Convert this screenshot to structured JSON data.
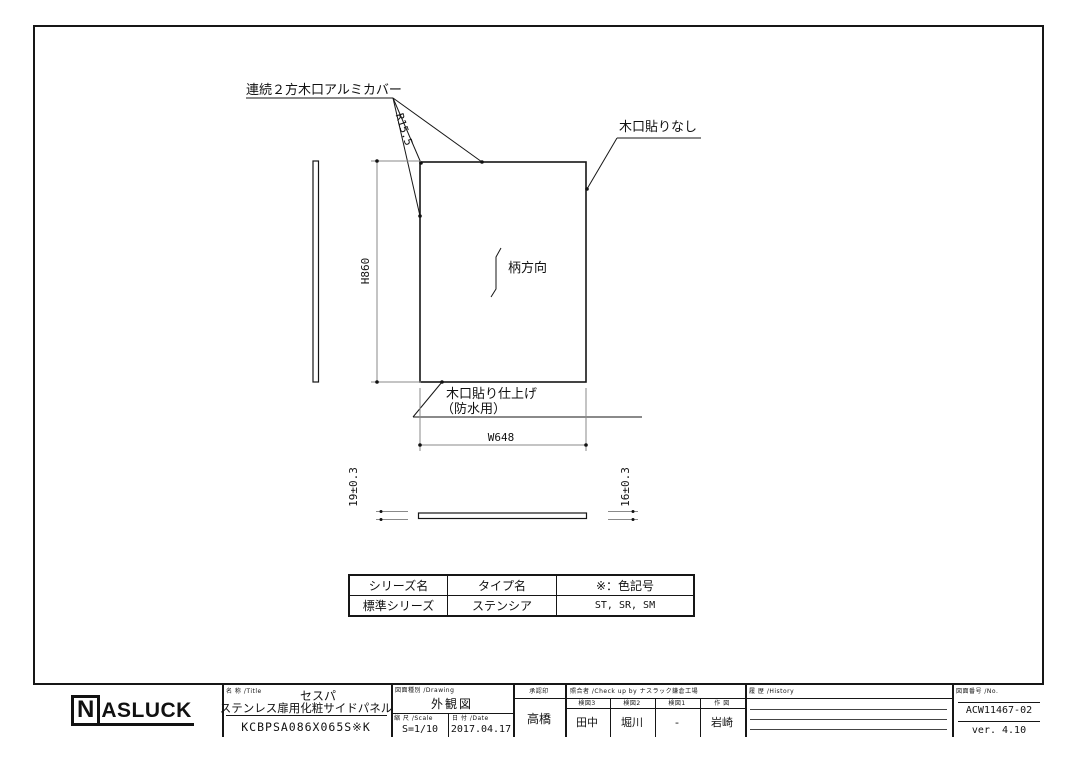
{
  "drawing": {
    "labels": {
      "edge_cover": "連続２方木口アルミカバー",
      "radius": "R15.5",
      "no_edge_band": "木口貼りなし",
      "grain_direction": "柄方向",
      "edge_band_finish_line1": "木口貼り仕上げ",
      "edge_band_finish_line2": "（防水用）"
    },
    "dimensions": {
      "height": "H860",
      "width": "W648",
      "thickness_left": "19±0.3",
      "thickness_right": "16±0.3"
    }
  },
  "spec_table": {
    "headers": [
      "シリーズ名",
      "タイプ名",
      "※：色記号"
    ],
    "row": [
      "標準シリーズ",
      "ステンシア",
      "ST, SR, SM"
    ]
  },
  "title_block": {
    "logo_n": "N",
    "logo_rest": "ASLUCK",
    "name_label": "名 称 /Title",
    "product_series": "セスパ",
    "product_name": "ステンレス扉用化粧サイドパネル",
    "model_number": "KCBPSA086X065S※K",
    "drawing_type_label": "図面種別 /Drawing",
    "drawing_type": "外観図",
    "scale_label": "縮 尺 /Scale",
    "scale": "S=1/10",
    "date_label": "日 付 /Date",
    "date": "2017.04.17",
    "approval_label": "承認印",
    "approver": "高橋",
    "check_label": "照合者 /Check up by ナスラック鎌倉工場",
    "check_columns": [
      {
        "label": "検図3",
        "name": "田中"
      },
      {
        "label": "検図2",
        "name": "堀川"
      },
      {
        "label": "検図1",
        "name": "-"
      },
      {
        "label": "作 図",
        "name": "岩崎"
      }
    ],
    "history_label": "履 歴 /History",
    "number_label": "図面番号 /No.",
    "drawing_number": "ACW11467-02",
    "version": "ver. 4.10"
  },
  "colors": {
    "line": "#161616",
    "dim_line": "#8a8a8a",
    "background": "#ffffff"
  }
}
